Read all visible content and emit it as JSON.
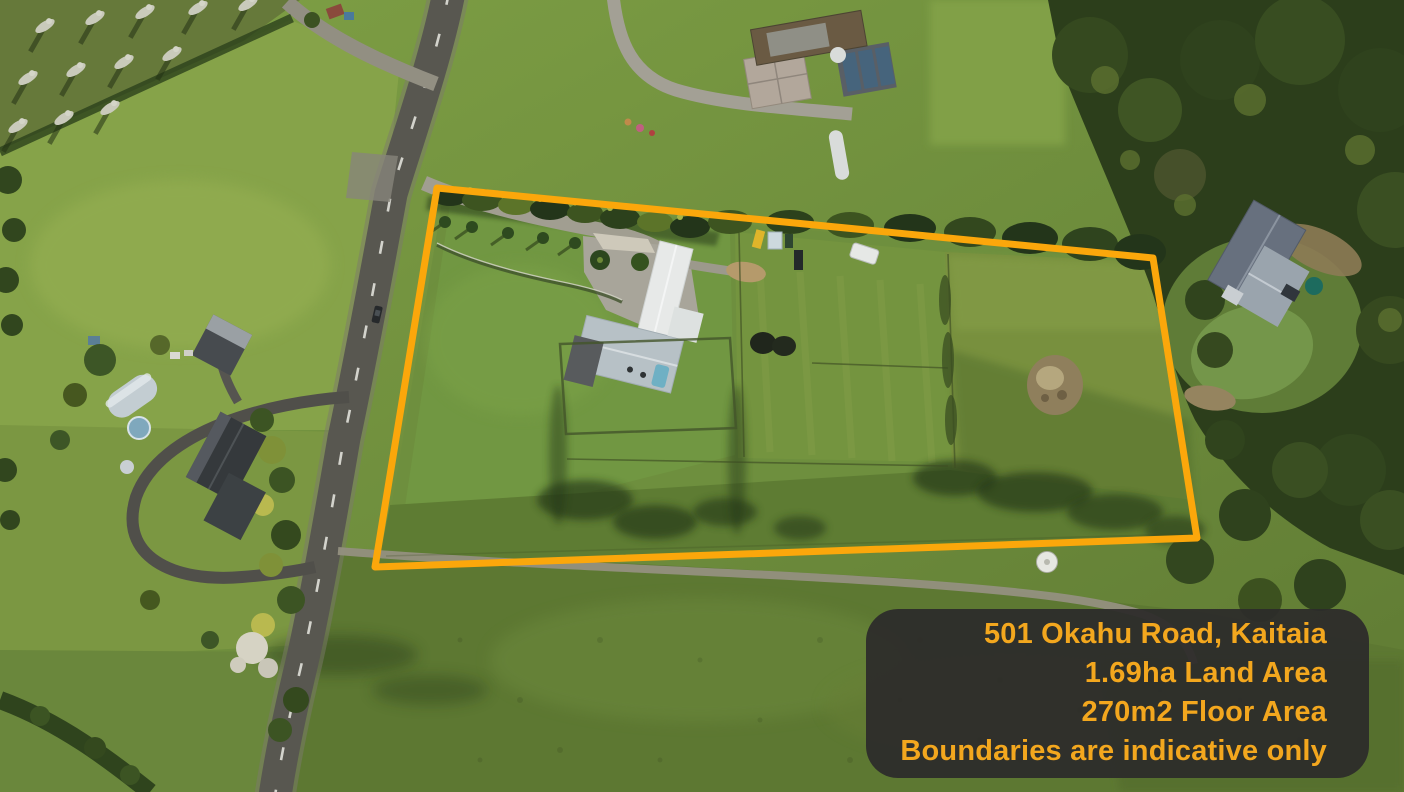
{
  "info_card": {
    "address": "501 Okahu Road, Kaitaia",
    "land_area": "1.69ha Land Area",
    "floor_area": "270m2 Floor Area",
    "disclaimer": "Boundaries are indicative only"
  },
  "boundary_overlay": {
    "points": "437,188 1153,258 1197,538 375,567",
    "color": "#FBA70B",
    "stroke_width": "7"
  },
  "colors": {
    "accent": "#F3A71E",
    "card-bg": "#2D2C2AF0",
    "boundary": "#FBA70B"
  }
}
